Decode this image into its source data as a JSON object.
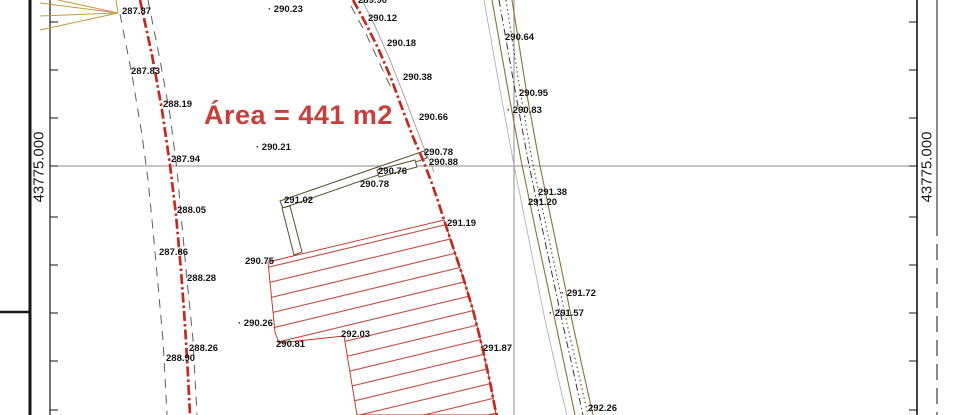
{
  "area_label": "Área = 441 m2",
  "grid_frame": {
    "left_coordinate_label": "43775.000",
    "right_coordinate_label": "43775.000"
  },
  "survey_points": [
    {
      "x": 122,
      "y": 6,
      "label": "287.87"
    },
    {
      "x": 131,
      "y": 66,
      "label": "287.83"
    },
    {
      "x": 163,
      "y": 99,
      "label": "288.19"
    },
    {
      "x": 268,
      "y": 4,
      "label": "· 290.23"
    },
    {
      "x": 358,
      "y": -5,
      "label": "289.90"
    },
    {
      "x": 368,
      "y": 13,
      "label": "290.12"
    },
    {
      "x": 387,
      "y": 38,
      "label": "290.18"
    },
    {
      "x": 403,
      "y": 72,
      "label": "290.38"
    },
    {
      "x": 419,
      "y": 112,
      "label": "290.66"
    },
    {
      "x": 256,
      "y": 142,
      "label": "· 290.21"
    },
    {
      "x": 171,
      "y": 154,
      "label": "287.94"
    },
    {
      "x": 424,
      "y": 147,
      "label": "290.78"
    },
    {
      "x": 429,
      "y": 157,
      "label": "290.88"
    },
    {
      "x": 378,
      "y": 166,
      "label": "290.76"
    },
    {
      "x": 360,
      "y": 179,
      "label": "290.78"
    },
    {
      "x": 284,
      "y": 195,
      "label": "291.02"
    },
    {
      "x": 177,
      "y": 205,
      "label": "288.05"
    },
    {
      "x": 159,
      "y": 247,
      "label": "287.86"
    },
    {
      "x": 187,
      "y": 273,
      "label": "288.28"
    },
    {
      "x": 245,
      "y": 256,
      "label": "290.75"
    },
    {
      "x": 447,
      "y": 218,
      "label": "291.19"
    },
    {
      "x": 238,
      "y": 318,
      "label": "· 290.26"
    },
    {
      "x": 341,
      "y": 329,
      "label": "292.03"
    },
    {
      "x": 276,
      "y": 339,
      "label": "290.81"
    },
    {
      "x": 189,
      "y": 343,
      "label": "288.26"
    },
    {
      "x": 166,
      "y": 353,
      "label": "288.90"
    },
    {
      "x": 483,
      "y": 343,
      "label": "291.87"
    },
    {
      "x": 505,
      "y": 32,
      "label": "290.64"
    },
    {
      "x": 519,
      "y": 88,
      "label": "290.95"
    },
    {
      "x": 507,
      "y": 105,
      "label": "· 290.83"
    },
    {
      "x": 538,
      "y": 187,
      "label": "291.38"
    },
    {
      "x": 528,
      "y": 197,
      "label": "291.20"
    },
    {
      "x": 561,
      "y": 288,
      "label": "· 291.72"
    },
    {
      "x": 549,
      "y": 308,
      "label": "· 291.57"
    },
    {
      "x": 588,
      "y": 403,
      "label": "292.26"
    }
  ],
  "colors": {
    "boundary_red": "#c02b20",
    "hatch_red": "#bf4a42",
    "area_red": "#c5403a",
    "survey_tan": "#c49a3f",
    "road_tan": "#8a7433",
    "label_black": "#141414"
  }
}
